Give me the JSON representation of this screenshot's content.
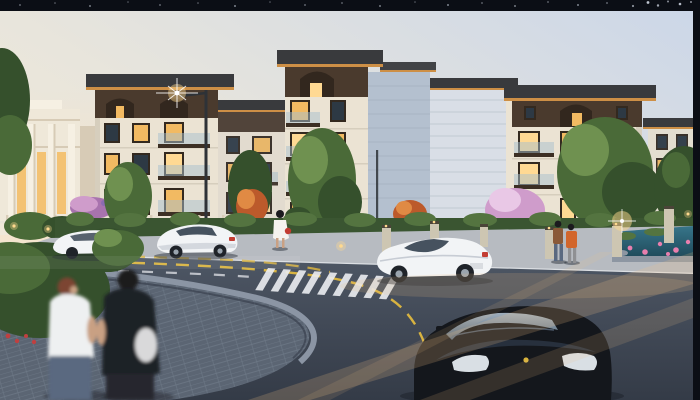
{
  "meta": {
    "title": "Residential community dusk rendering",
    "description": "Dusk architectural rendering of a low-rise residential community: modern four-storey apartment blocks with overhanging roofs and warmly lit windows, a classical clubhouse at left, landscaped gardens with green, red and pink blossom trees, a lotus pond, a curved street with yellow centerlines and white crosswalks, white cars, a black sports car in the foreground and pedestrians, letterboxed by a starry black bar on top and a black strip at right."
  },
  "scene": {
    "frame": {
      "top_bar": "black night-sky strip with small stars",
      "right_bar": "plain black strip"
    },
    "sky": "clear dusk sky, pale blue above fading to warm cream near the horizon",
    "buildings": [
      "classical stone clubhouse with columns and glowing tall windows",
      "apartment block far left (4 storeys, flat overhanging roof, lit underside)",
      "recessed apartment block left-center",
      "tall center apartment block with arched attic dormer and balconies",
      "banded side wall block right-center",
      "front apartment block right with balconies and lit windows",
      "partial apartment block at far right"
    ],
    "vehicles": [
      "white car parked behind shrub (left)",
      "white coupe driving away (left-center)",
      "white roadster driving right-to-left (center)",
      "black sports car with driver in the foreground"
    ],
    "people": [
      "blurred couple walking on the paved plaza (foreground left)",
      "woman in a white dress with a red bag on the sidewalk",
      "man in brown shirt and companion in orange jacket strolling near the pond"
    ],
    "landscape": [
      "street lamp with glowing head",
      "white garden fence with lit posts",
      "clipped hedge row along the sidewalk",
      "green trees, red maple trees, pink blossom trees",
      "lotus pond with pink flowers and rocks",
      "stone bollards with small lights",
      "warm light beams streaking across the road"
    ],
    "road": [
      "curved asphalt road",
      "double yellow dashed centerline",
      "white lane dashes",
      "white zebra crosswalk (center) and partial crosswalk (far left)",
      "curved herringbone-paved plaza corner with stone curb"
    ]
  },
  "palette": {
    "bg-black": "#0b0e15",
    "star": "#dfe6f2",
    "sky-top": "#ccd7e8",
    "sky-mid": "#e8e5dc",
    "sky-warm": "#f7ead4",
    "glow-warm": "#ffd9ae",
    "wall-lit": "#ebe3d3",
    "wall-shade": "#d6cebd",
    "wall-side": "#b4c0cf",
    "wall-far": "#d9dee6",
    "attic": "#4a3a2d",
    "attic-dark": "#32271e",
    "roof-dark": "#393a3d",
    "roof-glow": "#cd8f46",
    "frame-dark": "#33291f",
    "window-dark": "#2d3944",
    "window-lit": "#f2ba62",
    "window-lit2": "#ffd993",
    "glass-rail": "rgba(168,192,206,0.5)",
    "balcony-base": "#3c2f24",
    "club-wall": "#efe8d9",
    "club-accent": "#f6f0e3",
    "club-shadow": "#d7cbb6",
    "club-window": "#f3c273",
    "tree-dark": "#35502c",
    "tree-mid": "#4a6a38",
    "tree-light": "#6f9150",
    "tree-red": "#bc5a2b",
    "tree-red-hi": "#e08a44",
    "blossom": "#cf9ccb",
    "blossom-hi": "#e9c8e6",
    "blossom-deep": "#a873ae",
    "hedge": "#3a5531",
    "hedge-hi": "#547440",
    "sidewalk": "#b7bbc1",
    "curb": "#dcdfe3",
    "fence-white": "#e9e4d8",
    "pond": "#37758a",
    "pond-deep": "#1f4a5a",
    "lotus": "#e87fae",
    "rock": "#8d96a2",
    "road": "#4e5765",
    "road-dark": "#343b47",
    "plaza": "#5b6573",
    "plaza-line": "#6e7987",
    "plaza-curb": "#8b95a4",
    "lane-yellow": "#d8b340",
    "lane-white": "#eceef2",
    "car-white": "#f2f4f6",
    "car-white-shade": "#c7ccd4",
    "car-glass": "#46525f",
    "car-black": "#14171c",
    "car-black-hi": "#3a4a5e",
    "headlight": "#d9dfe4",
    "taillight": "#c33d33",
    "tyre": "#1f2329",
    "rim": "#9aa4ae",
    "pole": "#2e3237",
    "stone-post": "#cdc6b2",
    "stone-post-cap": "#4a4438",
    "skin": "#c9a083",
    "hair-dark": "#1b1a1e",
    "hair-red": "#7c4530",
    "shirt-white": "#eef0f1",
    "jeans": "#5a6980",
    "black-cloth": "#1e2026",
    "bag-white": "#d9d9da",
    "dress-white": "#f5f3ee",
    "bag-red": "#c23b30",
    "jacket-orange": "#d2662c",
    "shirt-brown": "#8a5a38",
    "pants-gray": "#8f9093",
    "light-warm": "#ffd98e",
    "beam-warm": "#f3c385",
    "flower-red": "#bf4040",
    "flower-purple": "#8b6bb0",
    "shadow": "#20252e"
  }
}
